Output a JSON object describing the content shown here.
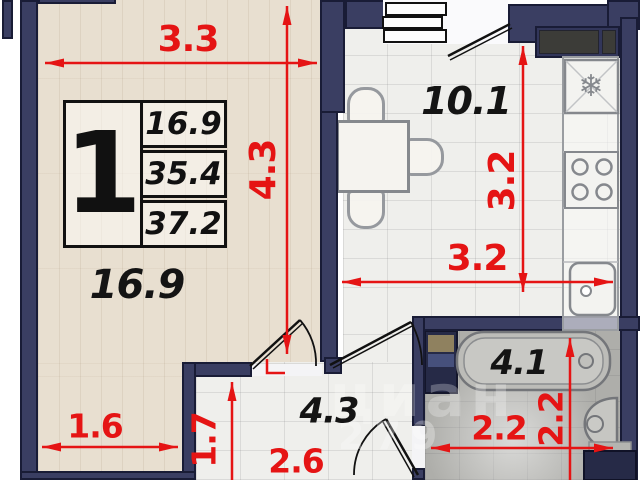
{
  "plan": {
    "legend": {
      "flat_number": "1",
      "rows": [
        {
          "value": "16.9"
        },
        {
          "value": "35.4"
        },
        {
          "value": "37.2"
        }
      ]
    },
    "rooms": {
      "living": {
        "area": "16.9"
      },
      "kitchen": {
        "area": "10.1"
      },
      "hallway": {
        "area": "4.3"
      },
      "bathroom": {
        "area": "4.1"
      }
    },
    "dimensions": {
      "living_width": "3.3",
      "living_height": "4.3",
      "kitchen_height": "3.2",
      "kitchen_width": "3.2",
      "living_niche_width": "1.6",
      "hall_height": "1.7",
      "hall_width": "2.6",
      "bath_width": "2.2",
      "bath_height": "2.2"
    },
    "icons": {
      "fridge_snowflake": "❄"
    },
    "colors": {
      "wall": "#3a3e62",
      "dimension_red": "#e51414",
      "living_floor": "#e8dfd0",
      "tile_floor": "#efefec",
      "bath_floor": "#aeaeaa"
    },
    "watermark": {
      "line1": "циан",
      "line2": "279"
    }
  }
}
